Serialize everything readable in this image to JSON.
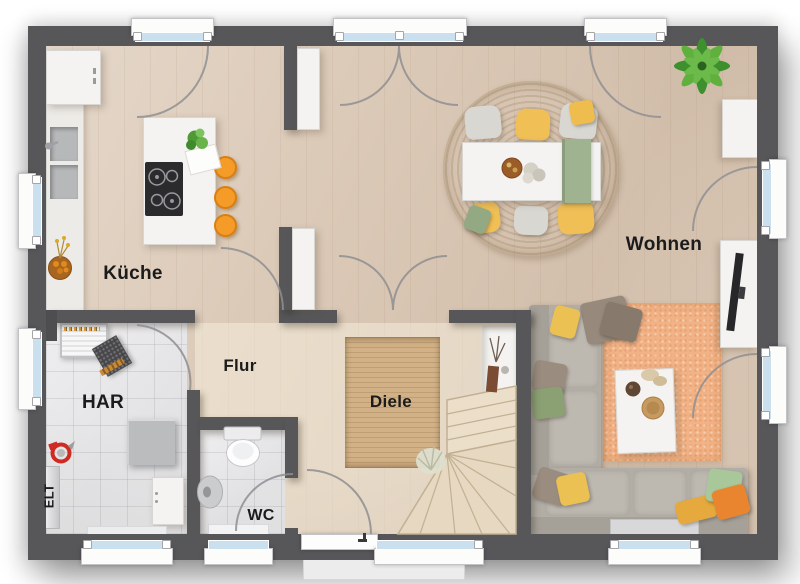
{
  "floorplan": {
    "type": "residential-ground-floor-plan",
    "rooms": [
      {
        "id": "kueche",
        "label": "Küche"
      },
      {
        "id": "wohnen",
        "label": "Wohnen"
      },
      {
        "id": "flur",
        "label": "Flur"
      },
      {
        "id": "diele",
        "label": "Diele"
      },
      {
        "id": "har",
        "label": "HAR"
      },
      {
        "id": "wc",
        "label": "WC"
      },
      {
        "id": "elt",
        "label": "ELT"
      }
    ],
    "features": {
      "window_count": 11,
      "exterior_doors": 1,
      "interior_door_arcs": 6,
      "staircase": "quarter-turn winder in Diele",
      "open_plan": "Küche–Essen–Wohnen"
    },
    "colors": {
      "wall": "#57575a",
      "wood_floor": "#dccab8",
      "hall_floor": "#e8d9c4",
      "tile_floor": "#e3e3e5",
      "glass": "#cbe0ee",
      "rug_jute": "#c9a878",
      "rug_peach": "#f2b286",
      "accent_orange": "#f59b28",
      "accent_yellow": "#f0bf55",
      "accent_green": "#9fb390",
      "sofa_gray": "#b2aea6"
    }
  }
}
